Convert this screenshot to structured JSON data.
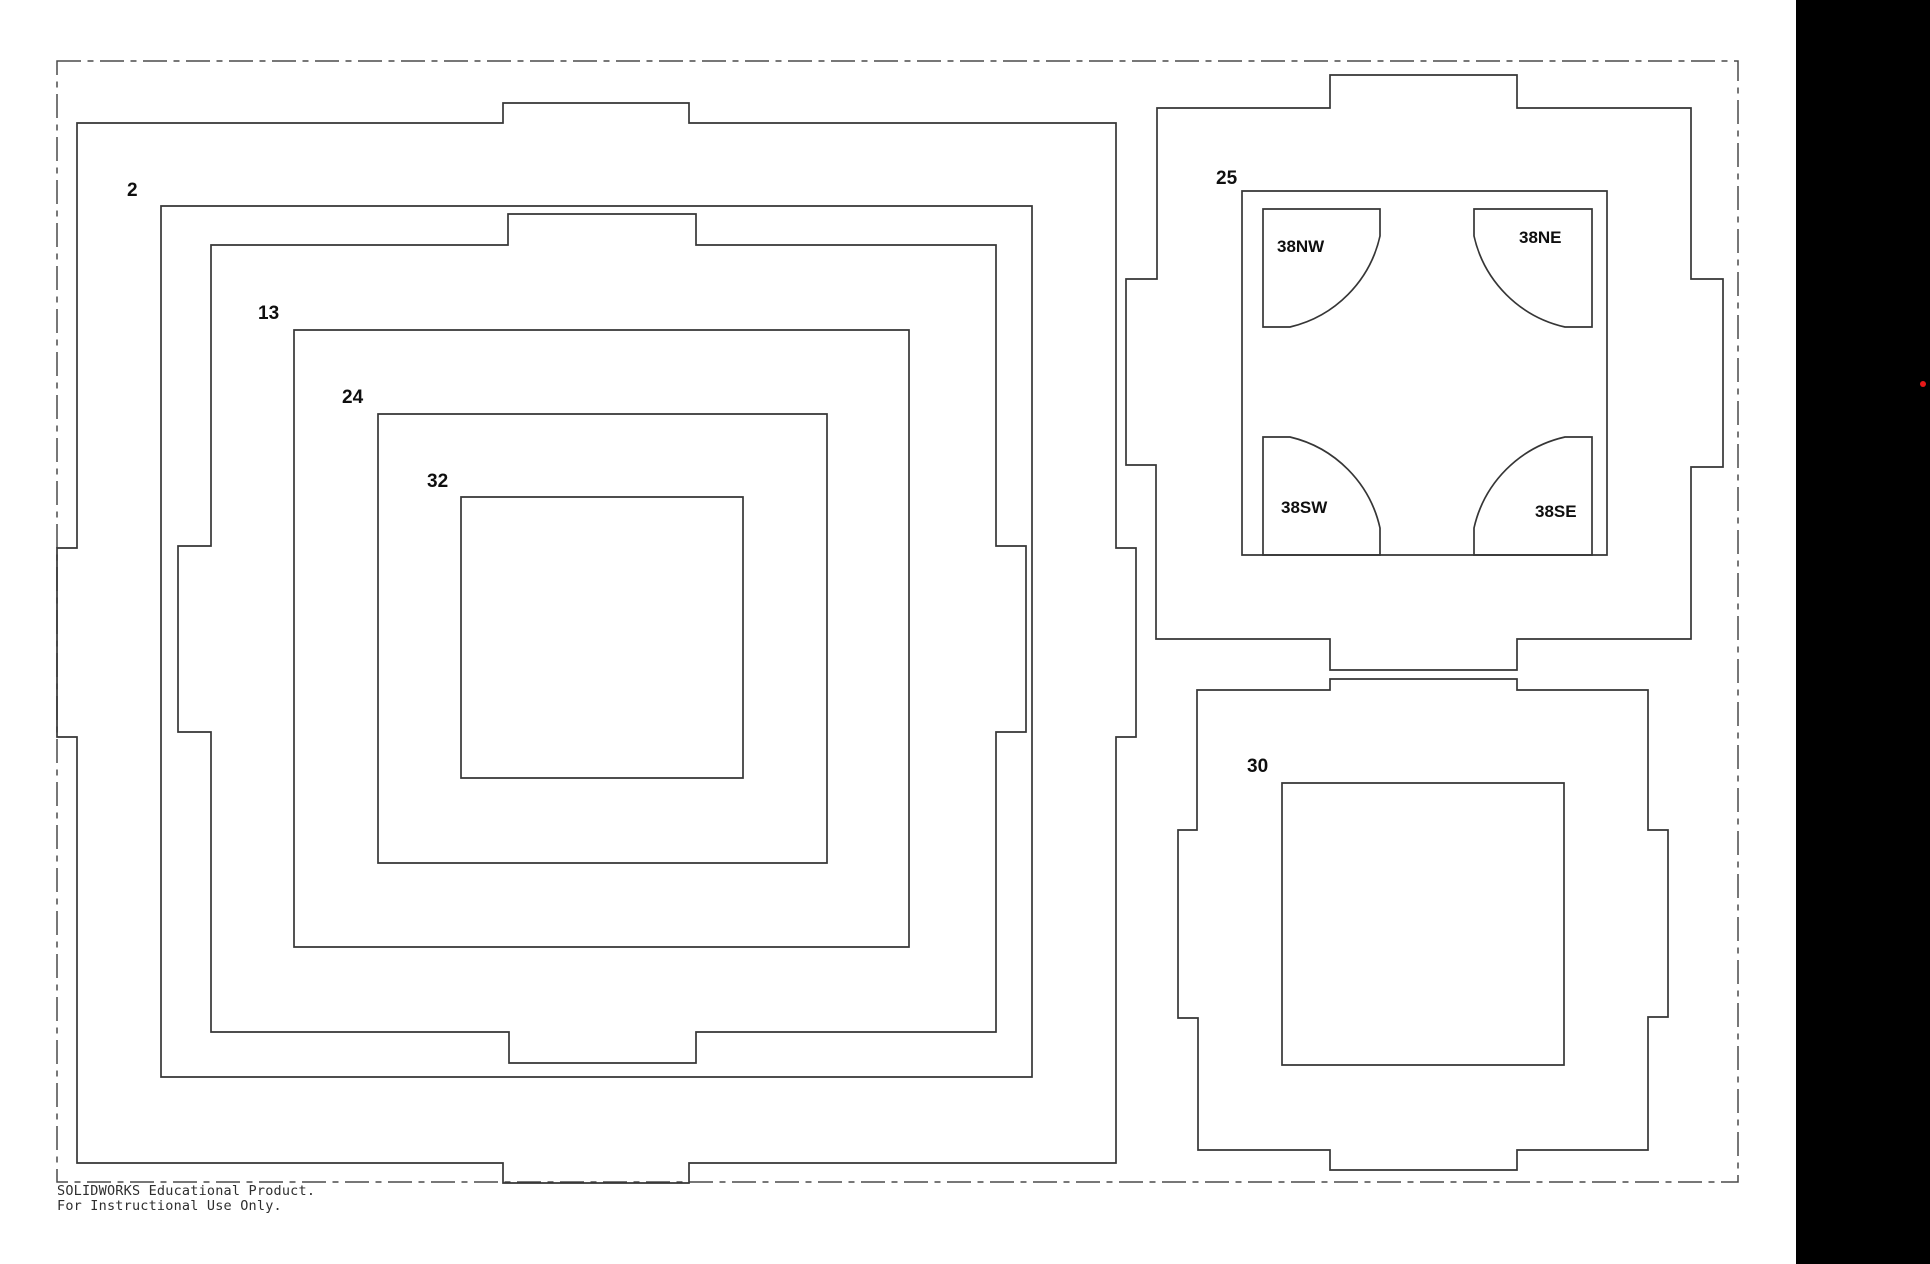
{
  "canvas": {
    "width": 1930,
    "height": 1264,
    "background": "#ffffff"
  },
  "style": {
    "line_color": "#363636",
    "line_width": 1.7,
    "phantom_color": "#4a4a4a",
    "phantom_width": 1.5,
    "phantom_dash": "24 6.5 6 6.5",
    "label_color": "#0f0f0f",
    "black_panel_color": "#000000",
    "red_dot_color": "#e81919"
  },
  "sheet_border": {
    "x": 57,
    "y": 61,
    "width": 1681,
    "height": 1121
  },
  "black_panel": {
    "x": 1796,
    "y": 0,
    "width": 134,
    "height": 1264
  },
  "red_dot": {
    "cx": 1923,
    "cy": 384,
    "r": 3
  },
  "parts": [
    {
      "name": "outer-ring-a",
      "label": "",
      "path": "M77,123 H503 V103 H689 V123 H1116 V548 H1136 V737 H1116 V1163 H689 V1183 H503 V1163 H77 V737 H57 V548 H77 Z"
    },
    {
      "name": "ring-b",
      "label": "2",
      "label_x": 127,
      "label_y": 196,
      "path": "M161,206 H1032 V1077 H161 Z"
    },
    {
      "name": "ring-c",
      "label": "",
      "path": "M211,245 H508 V214 H696 V245 H996 V546 H1026 V732 H996 V1032 H696 V1063 H509 V1032 H211 V732 H178 V546 H211 Z"
    },
    {
      "name": "ring-d",
      "label": "13",
      "label_x": 258,
      "label_y": 319,
      "path": "M294,330 H909 V947 H294 Z"
    },
    {
      "name": "ring-e",
      "label": "24",
      "label_x": 342,
      "label_y": 403,
      "path": "M378,414 H827 V863 H378 Z"
    },
    {
      "name": "square-f",
      "label": "32",
      "label_x": 427,
      "label_y": 487,
      "path": "M461,497 H743 V778 H461 Z"
    },
    {
      "name": "ring-g",
      "label": "",
      "path": "M1157,108 H1330 V75 H1517 V108 H1691 V279 H1723 V467 H1691 V639 H1517 V670 H1330 V639 H1156 V465 H1126 V279 H1157 Z"
    },
    {
      "name": "square-h",
      "label": "25",
      "label_x": 1216,
      "label_y": 184,
      "path": "M1242,191 H1607 V555 H1242 Z"
    },
    {
      "name": "corner-38nw",
      "label": "38NW",
      "tag": true,
      "label_x": 1277,
      "label_y": 252,
      "path": "M1263,209 H1380 V236 A120.5,120.5 0 0 1 1290,327 H1263 Z"
    },
    {
      "name": "corner-38ne",
      "label": "38NE",
      "tag": true,
      "label_x": 1519,
      "label_y": 243,
      "path": "M1474,209 H1592 V327 H1565 A120.5,120.5 0 0 1 1474,236 Z"
    },
    {
      "name": "corner-38sw",
      "label": "38SW",
      "tag": true,
      "label_x": 1281,
      "label_y": 513,
      "path": "M1263,437 H1290 A120.5,120.5 0 0 1 1380,528 V555 H1263 Z"
    },
    {
      "name": "corner-38se",
      "label": "38SE",
      "tag": true,
      "label_x": 1535,
      "label_y": 517,
      "path": "M1565,437 H1592 V555 H1474 V528 A120.5,120.5 0 0 1 1565,437 Z"
    },
    {
      "name": "ring-i",
      "label": "",
      "path": "M1197,690 H1330 V679 H1517 V690 H1648 V830 H1668 V1017 H1648 V1150 H1517 V1170 H1330 V1150 H1198 V1018 H1178 V830 H1197 Z"
    },
    {
      "name": "square-j",
      "label": "30",
      "label_x": 1247,
      "label_y": 772,
      "path": "M1282,783 H1564 V1065 H1282 Z"
    }
  ],
  "watermark": {
    "line1": "SOLIDWORKS Educational Product.",
    "line2": "For Instructional Use Only.",
    "x": 57,
    "y1": 1195,
    "y2": 1210
  }
}
